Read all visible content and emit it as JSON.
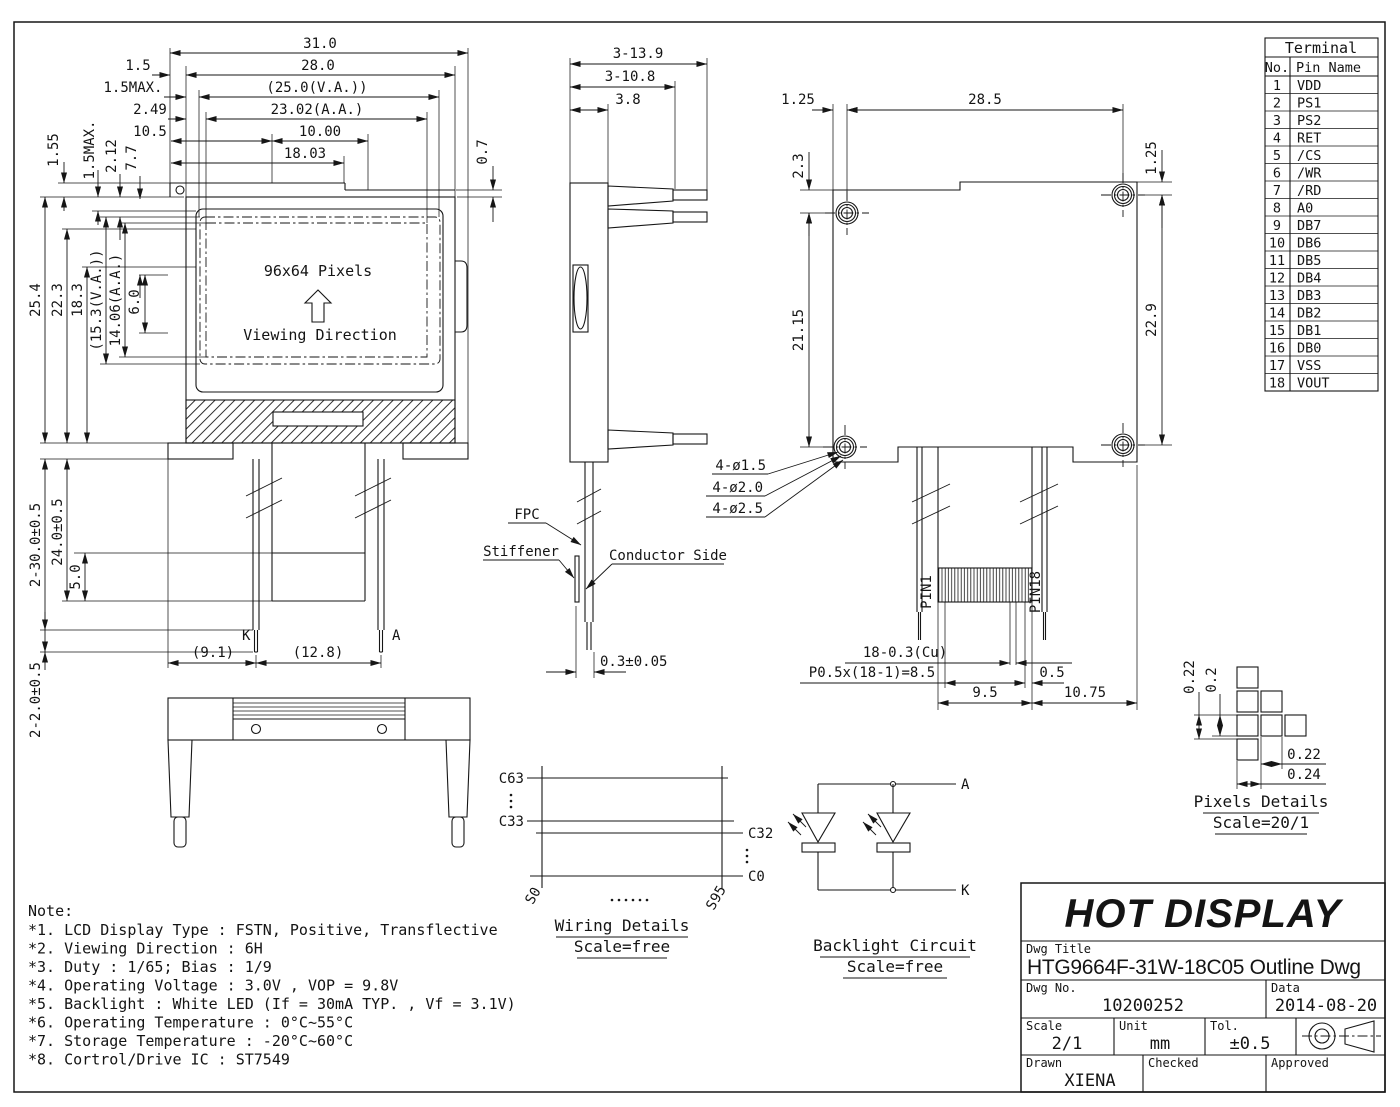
{
  "front_view": {
    "pixels_text": "96x64 Pixels",
    "viewing_direction": "Viewing Direction",
    "dim_31": "31.0",
    "dim_28": "28.0",
    "dim_1_5": "1.5",
    "dim_1_5max_top": "1.5MAX.",
    "dim_25_va": "(25.0(V.A.))",
    "dim_2_49": "2.49",
    "dim_23_aa": "23.02(A.A.)",
    "dim_10_5": "10.5",
    "dim_10_00": "10.00",
    "dim_18_03": "18.03",
    "dim_0_7": "0.7",
    "dim_1_55": "1.55",
    "dim_1_5max_left": "1.5MAX.",
    "dim_2_12": "2.12",
    "dim_7_7": "7.7",
    "dim_25_4": "25.4",
    "dim_22_3": "22.3",
    "dim_18_3": "18.3",
    "dim_15_3_va": "(15.3(V.A.))",
    "dim_14_06_aa": "14.06(A.A.)",
    "dim_6_0": "6.0",
    "dim_pin_len": "2-30.0±0.5",
    "dim_24_0": "24.0±0.5",
    "dim_5_0": "5.0",
    "dim_tip_len": "2-2.0±0.5",
    "dim_9_1": "(9.1)",
    "dim_12_8": "(12.8)",
    "label_k": "K",
    "label_a": "A"
  },
  "side_view": {
    "dim_3_13_9": "3-13.9",
    "dim_3_10_8": "3-10.8",
    "dim_3_8": "3.8",
    "label_fpc": "FPC",
    "label_stiffener": "Stiffener",
    "label_conductor_side": "Conductor Side",
    "dim_0_3": "0.3±0.05"
  },
  "back_view": {
    "dim_1_25_left": "1.25",
    "dim_28_5": "28.5",
    "dim_2_3": "2.3",
    "dim_1_25_right": "1.25",
    "dim_21_15": "21.15",
    "dim_22_9": "22.9",
    "hole_dia_1": "4-ø1.5",
    "hole_dia_2": "4-ø2.0",
    "hole_dia_3": "4-ø2.5",
    "label_pin1": "PIN1",
    "label_pin18": "PIN18",
    "dim_cu": "18-0.3(Cu)",
    "dim_pitch": "P0.5x(18-1)=8.5",
    "dim_0_5": "0.5",
    "dim_9_5": "9.5",
    "dim_10_75": "10.75"
  },
  "wiring_details": {
    "c63": "C63",
    "c33": "C33",
    "c32": "C32",
    "c0": "C0",
    "s0": "S0",
    "s95": "S95",
    "title": "Wiring Details",
    "scale": "Scale=free"
  },
  "backlight_circuit": {
    "anode": "A",
    "cathode": "K",
    "title": "Backlight Circuit",
    "scale": "Scale=free"
  },
  "pixels_details": {
    "dim_v_pitch": "0.22",
    "dim_v_size": "0.2",
    "dim_h_size": "0.22",
    "dim_h_pitch": "0.24",
    "title": "Pixels Details",
    "scale": "Scale=20/1"
  },
  "terminal_table": {
    "title": "Terminal",
    "col_no": "No.",
    "col_pin": "Pin Name",
    "pins": [
      {
        "no": "1",
        "name": "VDD"
      },
      {
        "no": "2",
        "name": "PS1"
      },
      {
        "no": "3",
        "name": "PS2"
      },
      {
        "no": "4",
        "name": "RET"
      },
      {
        "no": "5",
        "name": "/CS"
      },
      {
        "no": "6",
        "name": "/WR"
      },
      {
        "no": "7",
        "name": "/RD"
      },
      {
        "no": "8",
        "name": "A0"
      },
      {
        "no": "9",
        "name": "DB7"
      },
      {
        "no": "10",
        "name": "DB6"
      },
      {
        "no": "11",
        "name": "DB5"
      },
      {
        "no": "12",
        "name": "DB4"
      },
      {
        "no": "13",
        "name": "DB3"
      },
      {
        "no": "14",
        "name": "DB2"
      },
      {
        "no": "15",
        "name": "DB1"
      },
      {
        "no": "16",
        "name": "DB0"
      },
      {
        "no": "17",
        "name": "VSS"
      },
      {
        "no": "18",
        "name": "VOUT"
      }
    ]
  },
  "notes": {
    "heading": "Note:",
    "items": [
      "*1. LCD Display Type : FSTN, Positive, Transflective",
      "*2. Viewing Direction : 6H",
      "*3. Duty : 1/65; Bias : 1/9",
      "*4. Operating Voltage : 3.0V , VOP = 9.8V",
      "*5. Backlight : White LED (If = 30mA TYP. , Vf = 3.1V)",
      "*6. Operating Temperature : 0°C~55°C",
      "*7. Storage Temperature : -20°C~60°C",
      "*8. Cortrol/Drive IC : ST7549"
    ]
  },
  "title_block": {
    "company": "HOT DISPLAY",
    "dwg_title_label": "Dwg Title",
    "dwg_title": "HTG9664F-31W-18C05 Outline Dwg",
    "dwg_no_label": "Dwg No.",
    "dwg_no": "10200252",
    "date_label": "Data",
    "date": "2014-08-20",
    "scale_label": "Scale",
    "scale": "2/1",
    "unit_label": "Unit",
    "unit": "mm",
    "tol_label": "Tol.",
    "tol": "±0.5",
    "drawn_label": "Drawn",
    "drawn": "XIENA",
    "checked_label": "Checked",
    "approved_label": "Approved"
  }
}
